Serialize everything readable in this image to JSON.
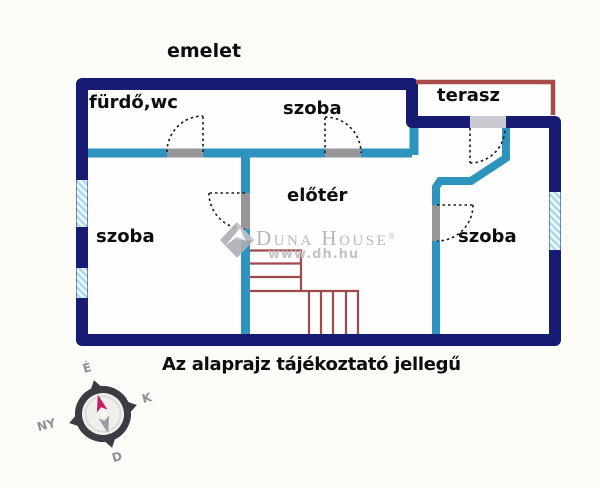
{
  "floor_title": "emelet",
  "caption": "Az alaprajz tájékoztató jellegű",
  "rooms": {
    "bathroom": "fürdő,wc",
    "bedroom_top": "szoba",
    "terrace": "terasz",
    "hall": "előtér",
    "bedroom_left": "szoba",
    "bedroom_right": "szoba"
  },
  "watermark": {
    "brand": "Duna House",
    "registered": "®",
    "website": "www.dh.hu"
  },
  "compass": {
    "north": "É",
    "east": "K",
    "south": "D",
    "west": "NY"
  },
  "colors": {
    "outer_wall_navy": "#171b72",
    "inner_wall_teal": "#2e94be",
    "terrace_outline_red": "#a84a45",
    "stairs_red": "#a04a4a",
    "door_opening_gray": "#97979b",
    "window_hatch_blue": "#a6d7ec",
    "watermark_gray": "#b9b9bf",
    "compass_needle_north": "#c22061",
    "compass_needle_south": "#9b9ba1"
  }
}
